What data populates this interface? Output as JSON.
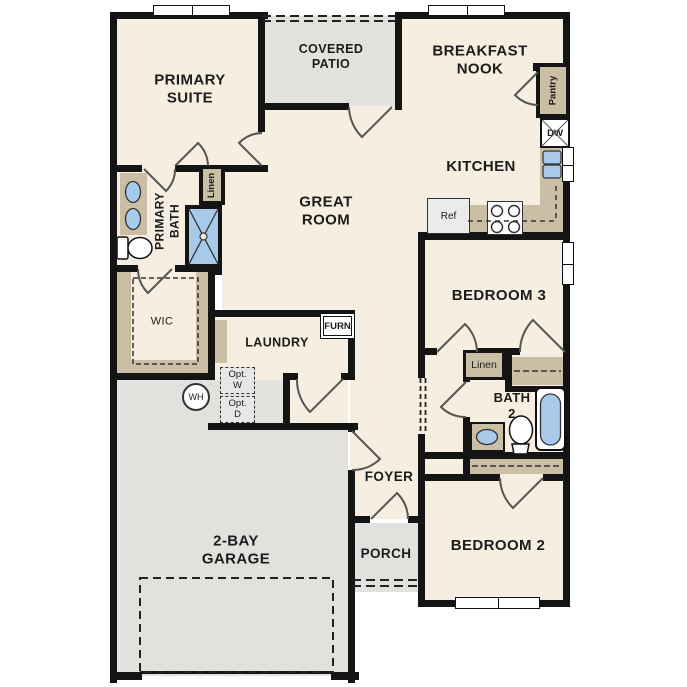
{
  "plan": {
    "labels": {
      "primary_suite": "PRIMARY SUITE",
      "covered_patio": "COVERED PATIO",
      "breakfast_nook": "BREAKFAST NOOK",
      "kitchen": "KITCHEN",
      "great_room": "GREAT ROOM",
      "primary_bath": "PRIMARY BATH",
      "wic": "WIC",
      "laundry": "LAUNDRY",
      "bedroom_3": "BEDROOM 3",
      "bath_2": "BATH 2",
      "foyer": "FOYER",
      "porch": "PORCH",
      "bedroom_2": "BEDROOM 2",
      "garage": "2-BAY GARAGE",
      "pantry": "Pantry",
      "linen_primary": "Linen",
      "linen_hall": "Linen",
      "dishwasher": "DW",
      "refrigerator": "Ref",
      "furnace": "FURN",
      "optional_washer": "Opt. W",
      "optional_dryer": "Opt. D",
      "water_heater": "WH"
    },
    "colors": {
      "floor": "#f6eee1",
      "outdoor": "#e2e1de",
      "cabinet": "#cabfa5",
      "fixture": "#a9c9ea",
      "wall": "#141414",
      "appliance": "#ebebeb",
      "text": "#1c1c1c"
    }
  }
}
